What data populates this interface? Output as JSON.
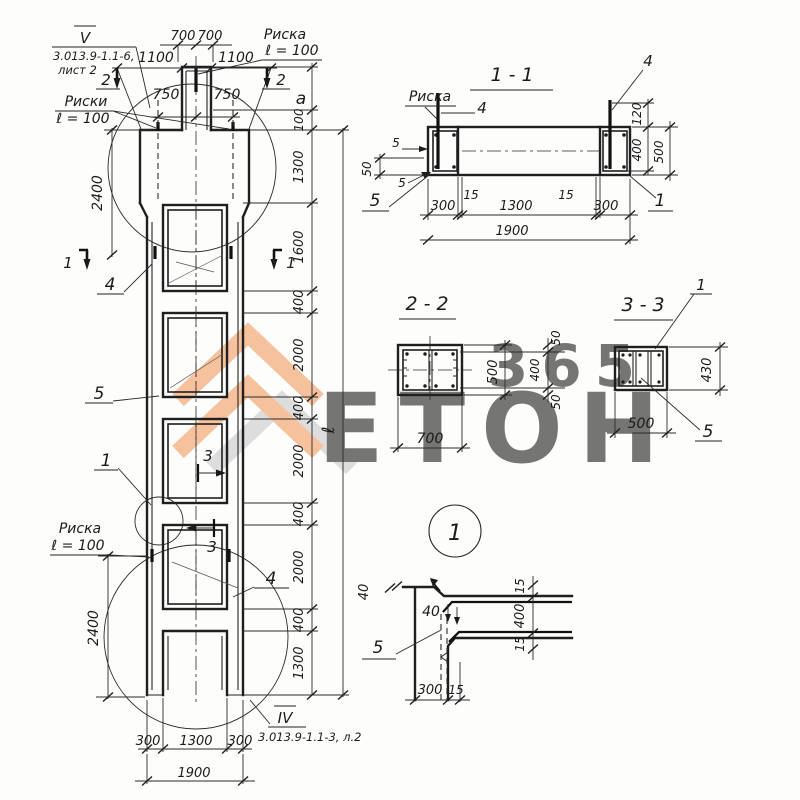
{
  "refs": {
    "top_roman": "V",
    "top_code": "3.013.9-1.1-6,",
    "top_sheet": "лист 2",
    "bottom_roman": "IV",
    "bottom_code": "3.013.9-1.1-3, л.2"
  },
  "elev": {
    "risk_tl1": "Риски",
    "risk_tl2": "ℓ = 100",
    "risk_tr1": "Риска",
    "risk_tr2": "ℓ = 100",
    "risk_ml1": "Риска",
    "risk_ml2": "ℓ = 100",
    "d700l": "700",
    "d700r": "700",
    "d1100l": "1100",
    "d1100r": "1100",
    "d750l": "750",
    "d750r": "750",
    "da": "a",
    "d100": "100",
    "chain": [
      "1300",
      "1600",
      "400",
      "2000",
      "400",
      "2000",
      "400",
      "2000",
      "400",
      "1300"
    ],
    "dl": "ℓ",
    "d2400t": "2400",
    "d2400b": "2400",
    "b300l": "300",
    "b1300": "1300",
    "b300r": "300",
    "b1900": "1900",
    "m2": "2",
    "m1": "1",
    "m3": "3",
    "l4a": "4",
    "l4b": "4",
    "l5": "5",
    "l1": "1"
  },
  "s11": {
    "title": "1 - 1",
    "riska": "Риска",
    "l4l": "4",
    "l4r": "4",
    "l5": "5",
    "l1": "1",
    "d5a": "5",
    "d5b": "5",
    "d50": "50",
    "d120": "120",
    "d400": "400",
    "d500": "500",
    "b300l": "300",
    "b15l": "15",
    "b1300": "1300",
    "b15r": "15",
    "b300r": "300",
    "b1900": "1900"
  },
  "s22": {
    "title": "2 - 2",
    "d700": "700",
    "d500": "500",
    "d50t": "50",
    "d400": "400",
    "d50b": "50"
  },
  "s33": {
    "title": "3 - 3",
    "l1": "1",
    "l5": "5",
    "d430": "430",
    "d500": "500"
  },
  "det1": {
    "bubble": "1",
    "l5": "5",
    "d40a": "40",
    "d40b": "40",
    "d15t": "15",
    "d400": "400",
    "d15b": "15",
    "b300": "300",
    "b15": "15"
  },
  "watermark": {
    "brand": "ЕТОН",
    "number": "365",
    "accent": "#f09b5f",
    "gray": "#c9c9c9"
  }
}
